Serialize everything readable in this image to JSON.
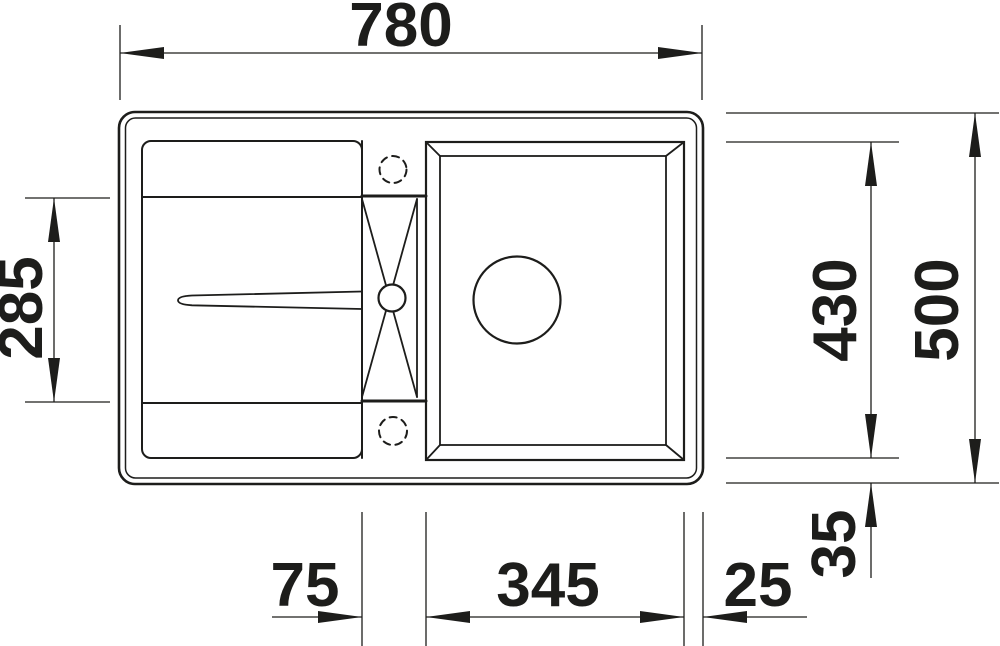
{
  "drawing": {
    "type": "technical-dimension-drawing",
    "subject": "kitchen sink with drainboard, tap ledge and single bowl — top view",
    "line_color": "#1d1d1b",
    "background_color": "#ffffff",
    "dimensions": {
      "overall_width": "780",
      "drainboard_recess_height": "285",
      "bowl_outer_height": "430",
      "overall_height": "500",
      "bowl_bottom_edge_offset": "35",
      "tap_ledge_width": "75",
      "bowl_outer_width": "345",
      "bowl_right_edge_offset": "25"
    }
  }
}
